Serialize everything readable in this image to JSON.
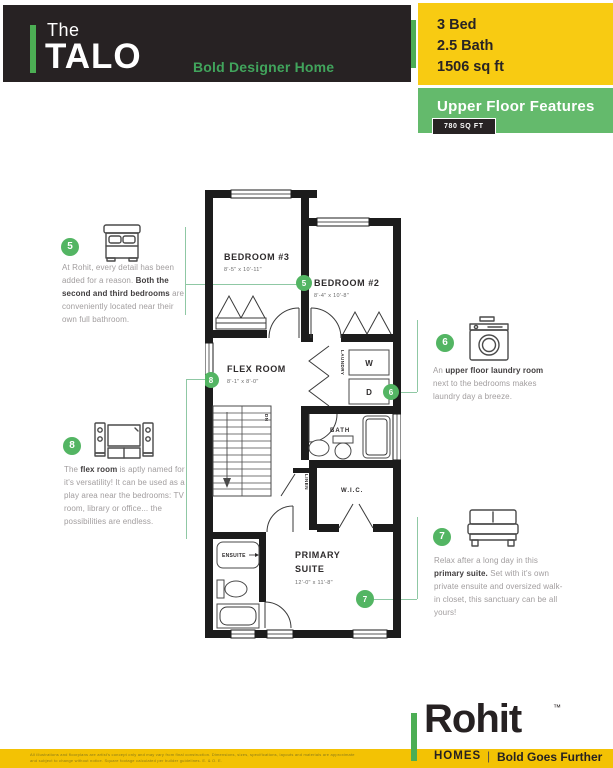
{
  "header": {
    "brand_prefix": "The",
    "brand_name": "TALO",
    "tagline": "Bold Designer Home",
    "specs": [
      "3 Bed",
      "2.5 Bath",
      "1506 sq ft"
    ]
  },
  "features_banner": {
    "title": "Upper Floor Features",
    "area_badge": "780 SQ FT"
  },
  "plan": {
    "bedroom3": {
      "name": "BEDROOM #3",
      "dims": "8'-5\" x 10'-11\""
    },
    "bedroom2": {
      "name": "BEDROOM #2",
      "dims": "8'-4\" x 10'-8\""
    },
    "flex_room": {
      "name": "FLEX ROOM",
      "dims": "8'-1\" x 8'-0\""
    },
    "primary_suite": {
      "name_line1": "PRIMARY",
      "name_line2": "SUITE",
      "dims": "12'-0\" x 11'-8\""
    },
    "laundry": "LAUNDRY",
    "washer": "W",
    "dryer": "D",
    "bath": "BATH",
    "wic": "W.I.C.",
    "linen": "LINEN",
    "ensuite": "ENSUITE",
    "stairs_dn": "DN",
    "markers": {
      "bedrooms": "5",
      "laundry": "6",
      "primary": "7",
      "flex": "8"
    }
  },
  "annotations": {
    "bedrooms": {
      "number": "5",
      "segments": [
        {
          "t": "At Rohit, every detail has been added for a reason. ",
          "b": false
        },
        {
          "t": "Both the second and third bedrooms",
          "b": true
        },
        {
          "t": " are conveniently located near their own full bathroom.",
          "b": false
        }
      ]
    },
    "laundry": {
      "number": "6",
      "segments": [
        {
          "t": "An ",
          "b": false
        },
        {
          "t": "upper floor laundry room",
          "b": true
        },
        {
          "t": " next to the bedrooms makes laundry day a breeze.",
          "b": false
        }
      ]
    },
    "primary": {
      "number": "7",
      "segments": [
        {
          "t": "Relax after a long day in this ",
          "b": false
        },
        {
          "t": "primary suite.",
          "b": true
        },
        {
          "t": " Set with it's own private ensuite and oversized walk-in closet, this sanctuary can be all yours!",
          "b": false
        }
      ]
    },
    "flex": {
      "number": "8",
      "segments": [
        {
          "t": "The ",
          "b": false
        },
        {
          "t": "flex room",
          "b": true
        },
        {
          "t": " is aptly named for it's versatility! It can be used as a play area near the bedrooms: TV room, library or office... the possibilities are endless.",
          "b": false
        }
      ]
    }
  },
  "footer": {
    "brand": "Rohit",
    "trademark": "™",
    "homes": "HOMES",
    "divider": "|",
    "slogan": "Bold Goes Further",
    "disclaimer_line1": "All illustrations and floorplans are artist's concept only and may vary from final construction. Dimensions, sizes, specifications, layouts and materials are approximate",
    "disclaimer_line2": "and subject to change without notice. Square footage calculated per builder guidelines. E. & O. E."
  },
  "colors": {
    "dark": "#272223",
    "brand_yellow": "#F8CB12",
    "banner_green": "#64BA6C",
    "accent_green": "#4CAE54",
    "marker_green": "#53B563",
    "connector_green": "#8FC8A4",
    "footer_yellow": "#F3C204"
  }
}
